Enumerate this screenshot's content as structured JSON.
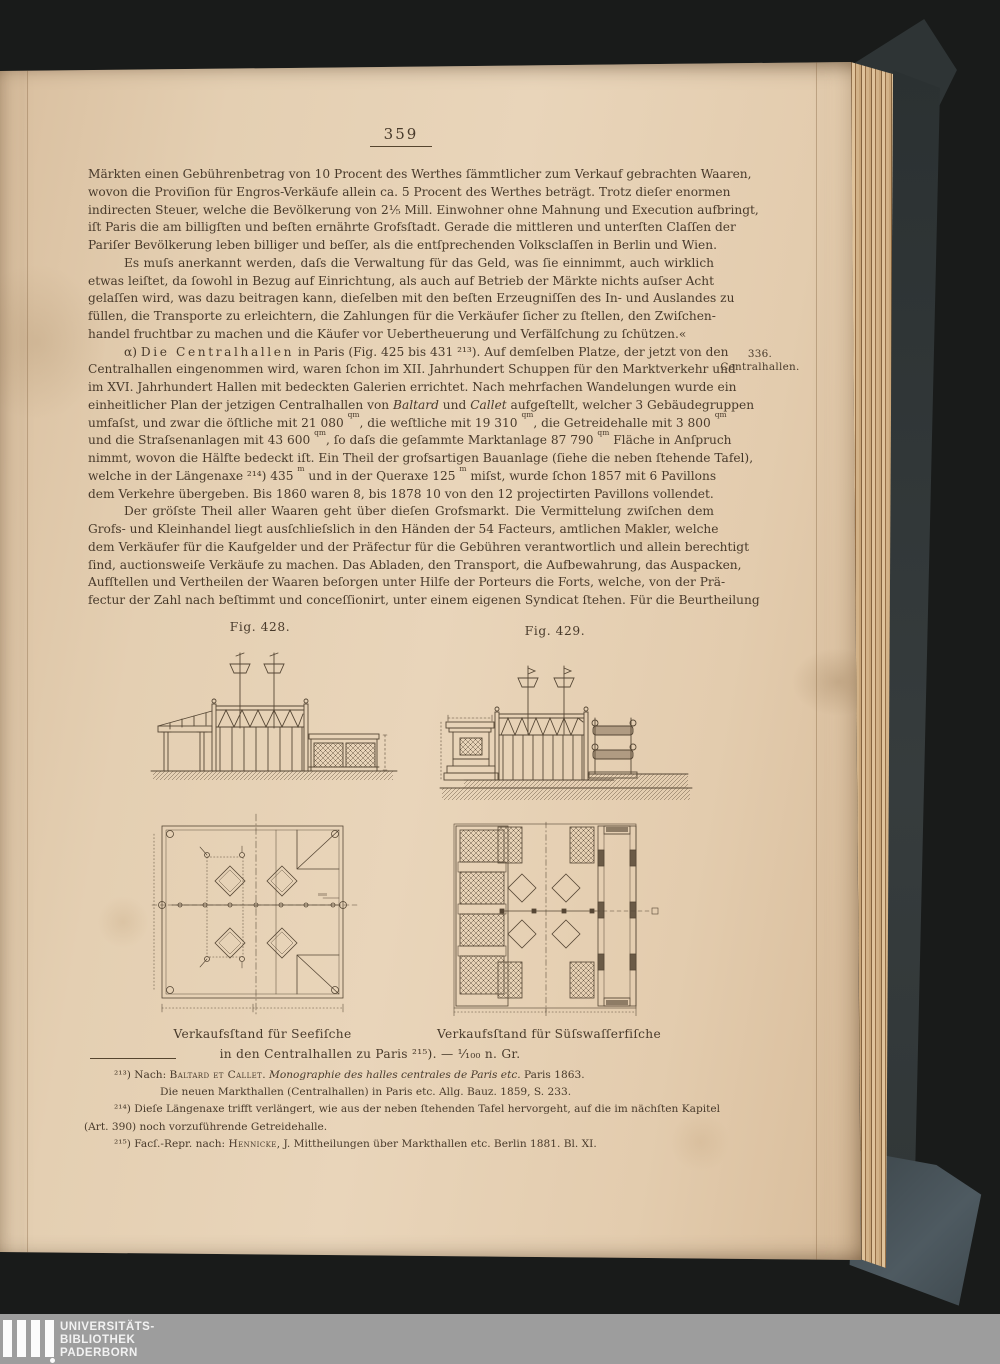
{
  "window": {
    "width": 1000,
    "height": 1364
  },
  "page": {
    "number": "359",
    "margin_note": {
      "number": "336.",
      "label": "Centralhallen."
    },
    "body": {
      "p1": {
        "indent": 0,
        "last_just": false,
        "lines": [
          "Märkten einen Gebührenbetrag von 10 Procent des Werthes ſämmtlicher zum Verkauf gebrachten Waaren,",
          "wovon die Proviſion für Engros-Verkäufe allein ca. 5 Procent des Werthes beträgt.  Trotz dieſer enormen",
          "indirecten Steuer, welche die Bevölkerung von 2¹⁄₅ Mill. Einwohner ohne Mahnung und Execution aufbringt,",
          "iſt Paris die am billigſten und beſten ernährte Grofsſtadt.  Gerade die mittleren und unterſten Claſſen der",
          "Pariſer Bevölkerung leben billiger und beſſer, als die entſprechenden Volksclaſſen in Berlin und Wien."
        ]
      },
      "p2": {
        "indent": 36,
        "last_just": false,
        "lines": [
          "Es muſs anerkannt werden, daſs die Verwaltung für das Geld, was ſie einnimmt, auch wirklich",
          "etwas leiſtet, da ſowohl in Bezug auf Einrichtung, als auch auf Betrieb der Märkte nichts auſser Acht",
          "gelaſſen wird, was dazu beitragen kann, dieſelben mit den beſten Erzeugniſſen des In- und Auslandes zu",
          "füllen, die Transporte zu erleichtern, die Zahlungen für die Verkäufer ſicher zu ſtellen, den Zwiſchen-",
          "handel fruchtbar zu machen und die Käufer vor Uebertheuerung und Verfälſchung zu ſchützen.«"
        ]
      },
      "p3": {
        "indent": 36,
        "last_just": false,
        "lines": [
          "α) ~Die Centralhallen~ in Paris (Fig. 425 bis 431 ²¹³).  Auf demſelben Platze, der jetzt von den",
          "Centralhallen eingenommen wird, waren ſchon im XII. Jahrhundert Schuppen für den Marktverkehr und",
          "im XVI. Jahrhundert Hallen mit bedeckten Galerien errichtet.  Nach mehrfachen Wandelungen wurde ein",
          "einheitlicher Plan der jetzigen Centralhallen von *Baltard* und *Callet* aufgeſtellt, welcher 3 Gebäudegruppen",
          "umfaſst, und zwar die öſtliche mit 21 080 ^qm^, die weſtliche mit 19 310 ^qm^, die Getreidehalle mit 3 800 ^qm^",
          "und die Straſsenanlagen mit 43 600 ^qm^, ſo daſs die geſammte Marktanlage 87 790 ^qm^ Fläche in Anſpruch",
          "nimmt, wovon die Hälfte bedeckt iſt.  Ein Theil der grofsartigen Bauanlage (ſiehe die neben ſtehende Tafel),",
          "welche in der Längenaxe ²¹⁴) 435 ^m^ und in der Queraxe 125 ^m^ miſst, wurde ſchon 1857 mit 6 Pavillons",
          "dem Verkehre übergeben.  Bis 1860 waren 8, bis 1878 10 von den 12 projectirten Pavillons vollendet."
        ]
      },
      "p4": {
        "indent": 36,
        "last_just": true,
        "lines": [
          "Der gröſste Theil aller Waaren geht über dieſen Grofsmarkt.  Die Vermittelung zwiſchen dem",
          "Grofs- und Kleinhandel liegt ausſchlieſslich in den Händen der 54 Facteurs, amtlichen Makler, welche",
          "dem Verkäufer für die Kaufgelder und der Präfectur für die Gebühren verantwortlich und allein berechtigt",
          "ſind, auctionsweiſe Verkäufe zu machen.  Das Abladen, den Transport, die Aufbewahrung, das Auspacken,",
          "Aufſtellen und Vertheilen der Waaren beſorgen unter Hilfe der Porteurs die Forts, welche, von der Prä-",
          "fectur der Zahl nach beſtimmt und conceſſionirt, unter einem eigenen Syndicat ſtehen.  Für die Beurtheilung"
        ]
      }
    },
    "figures": {
      "fig428_label": "Fig. 428.",
      "fig429_label": "Fig. 429.",
      "caption_left": "Verkaufsſtand für Seefiſche",
      "caption_right": "Verkaufsſtand für Süſswaſſerfiſche",
      "caption_shared": "in den Centralhallen zu Paris ²¹⁵). — ¹⁄₁₀₀ n. Gr."
    },
    "footnotes": {
      "lines": [
        {
          "t": "²¹³) Nach: °Baltard et Callet°.  *Monographie des halles centrales de Paris etc.*  Paris 1863.",
          "ind": 30,
          "just": false
        },
        {
          "t": "Die neuen Markthallen (Centralhallen) in Paris etc.  Allg. Bauz. 1859, S. 233.",
          "ind": 76,
          "just": false
        },
        {
          "t": "²¹⁴) Dieſe Längenaxe trifft verlängert, wie aus der neben ſtehenden Tafel hervorgeht, auf die im nächſten Kapitel",
          "ind": 30,
          "just": true
        },
        {
          "t": "(Art. 390) noch vorzuführende Getreidehalle.",
          "ind": 0,
          "just": false
        },
        {
          "t": "²¹⁵) Facſ.-Repr. nach: °Hennicke°, J.  Mittheilungen über Markthallen etc.  Berlin 1881. Bl. XI.",
          "ind": 30,
          "just": false
        }
      ]
    }
  },
  "banner": {
    "lines": [
      "UNIVERSITÄTS-",
      "BIBLIOTHEK",
      "PADERBORN"
    ]
  },
  "colors": {
    "background": "#191b1a",
    "page_paper": "#e5cfb2",
    "ink": "#483a2b",
    "cover": "#343a3b",
    "banner_bg": "#9d9d9d",
    "banner_text": "#f2f2f2"
  }
}
